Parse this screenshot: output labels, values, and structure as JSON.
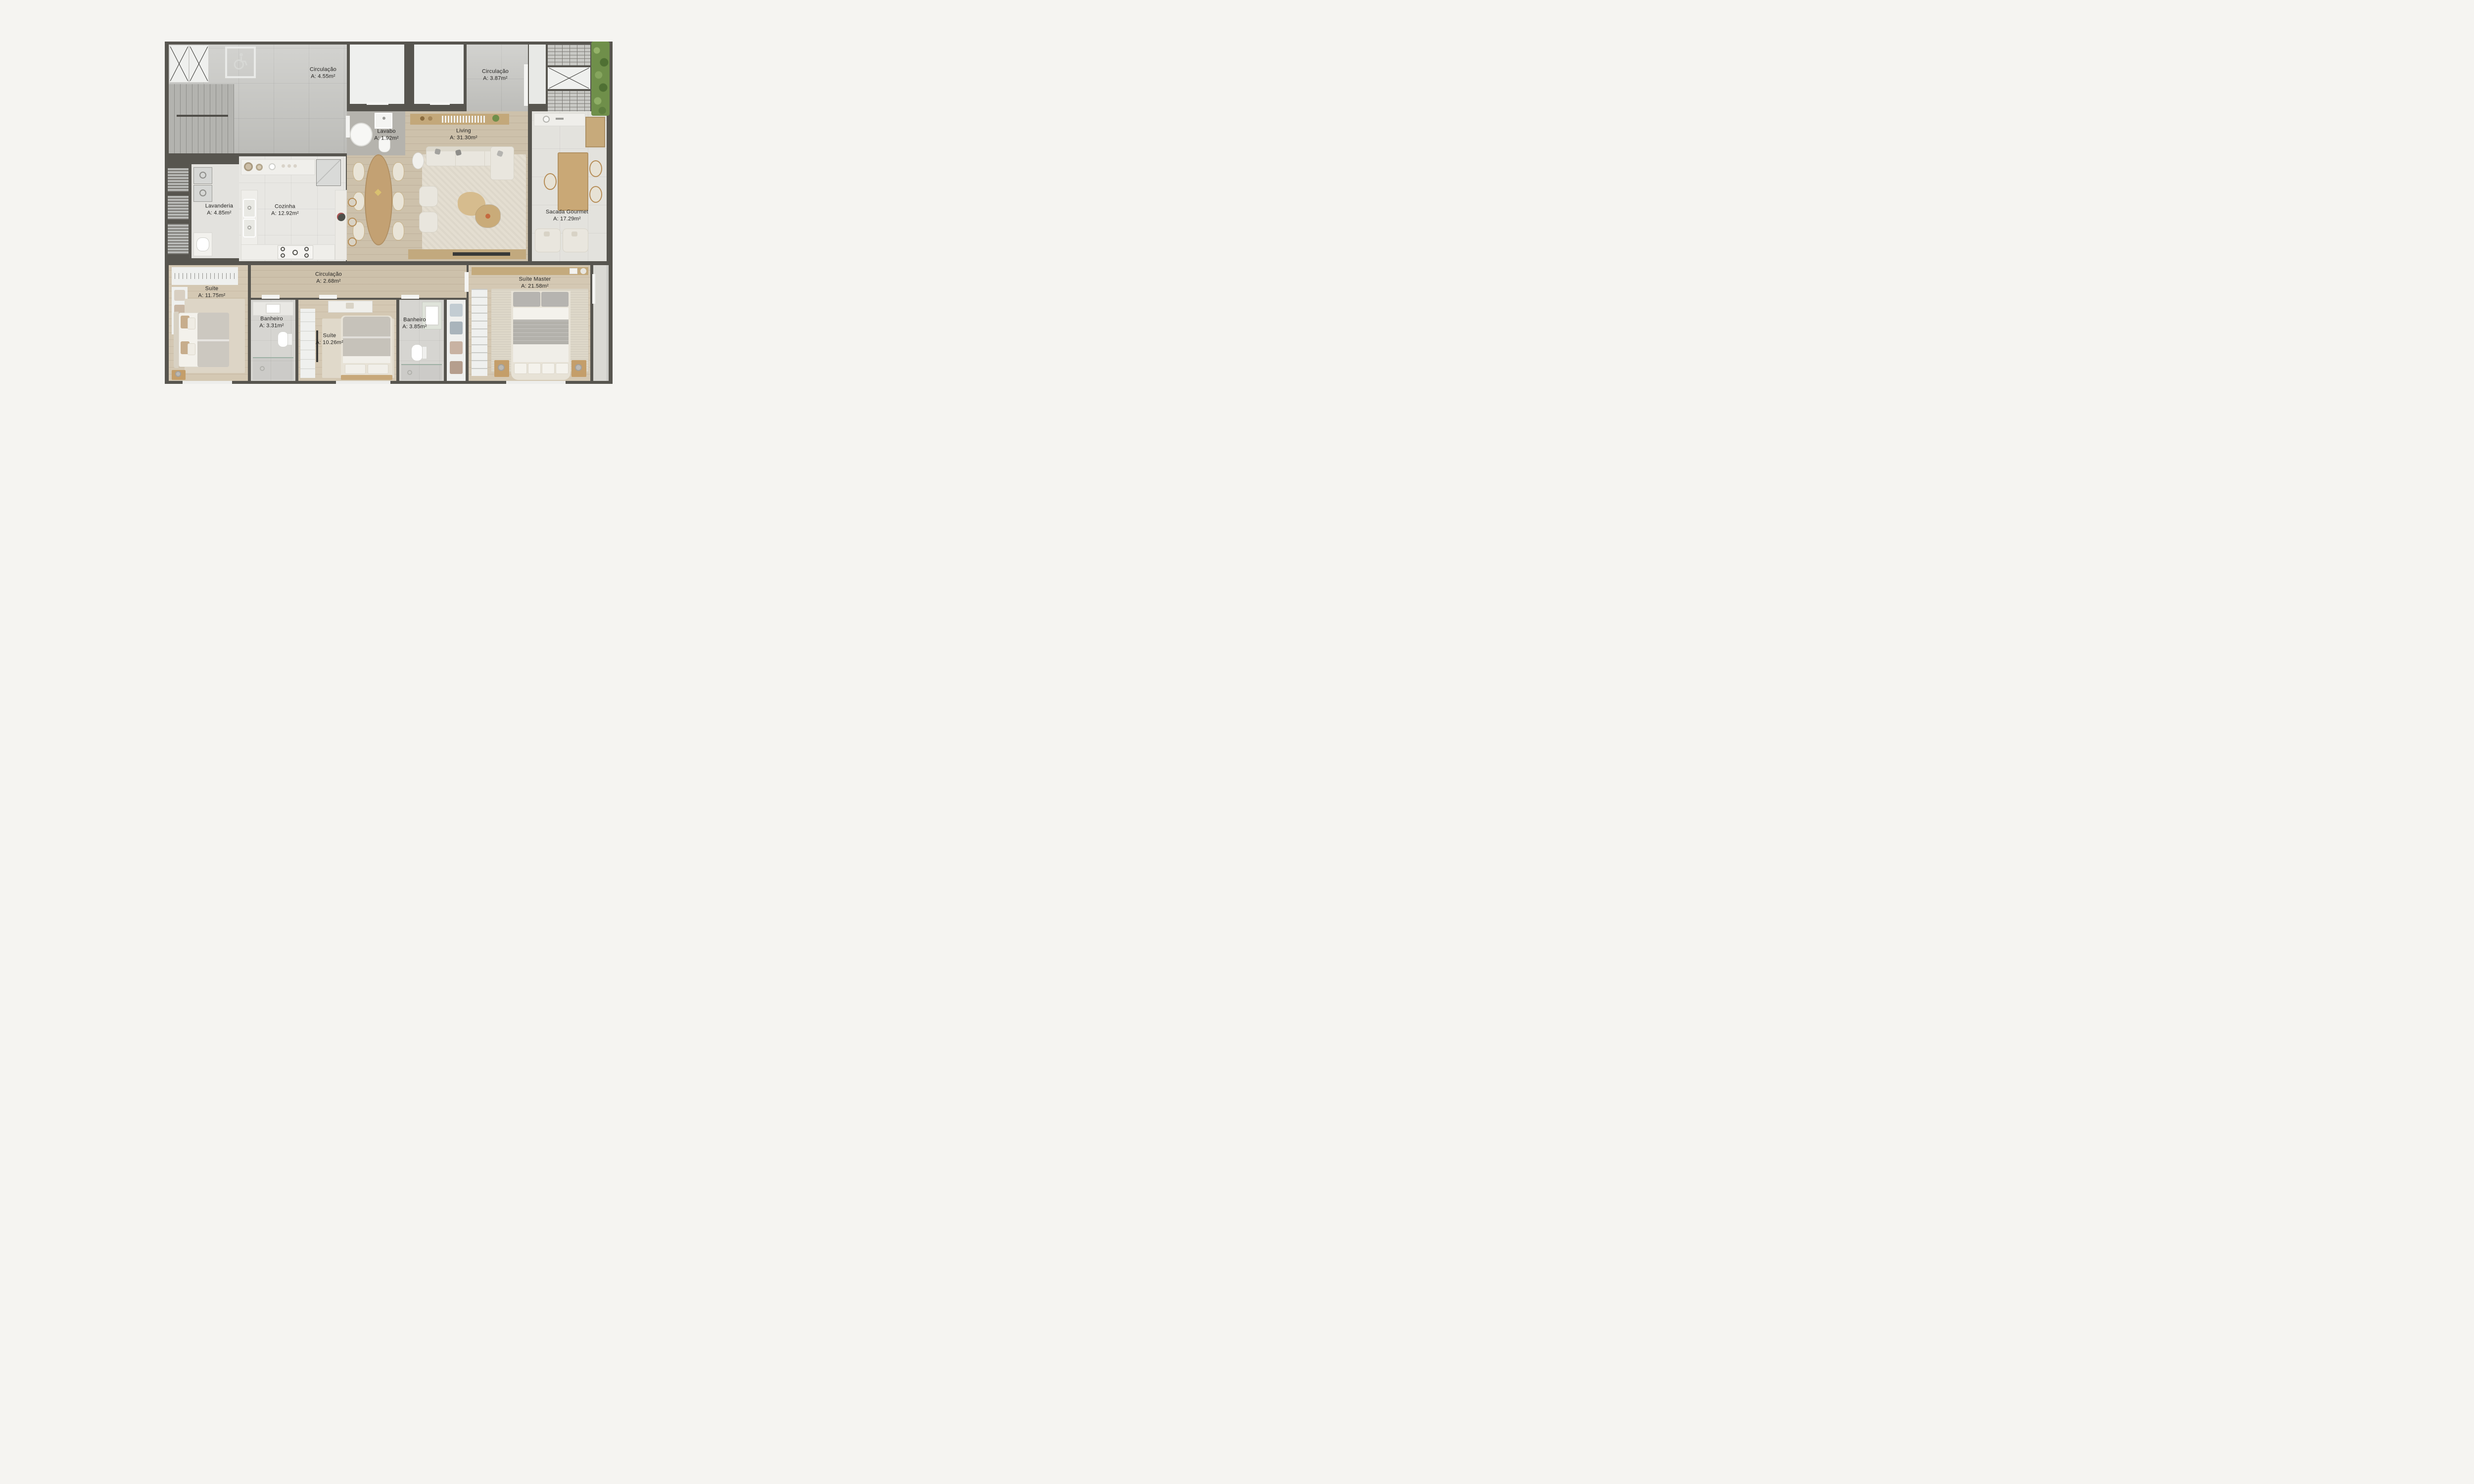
{
  "page": {
    "background": "#f5f4f1",
    "type": "apartment floor plan, top-down render"
  },
  "colors": {
    "walls": "#57554f",
    "concrete_floor": "#c6c6c2",
    "wood_floor": "#cdc1ab",
    "kitchen_tile": "#e8e7e3",
    "balcony_tile": "#e3e2dd",
    "hedge_green": "#6f8f4a",
    "label_text": "#232220",
    "furniture_cream": "#e9e6de",
    "counter_stone": "#efeeea",
    "table_wood": "#c3a173"
  },
  "rooms": [
    {
      "id": "circulacao-1",
      "name": "Circulação",
      "area": "A: 4.55m²"
    },
    {
      "id": "circulacao-2",
      "name": "Circulação",
      "area": "A: 3.87m²"
    },
    {
      "id": "lavabo",
      "name": "Lavabo",
      "area": "A: 1.92m²"
    },
    {
      "id": "living",
      "name": "Living",
      "area": "A: 31.30m²"
    },
    {
      "id": "lavanderia",
      "name": "Lavanderia",
      "area": "A: 4.85m²"
    },
    {
      "id": "cozinha",
      "name": "Cozinha",
      "area": "A: 12.92m²"
    },
    {
      "id": "sacada-gourmet",
      "name": "Sacada Gourmet",
      "area": "A: 17.29m²"
    },
    {
      "id": "circulacao-3",
      "name": "Circulação",
      "area": "A: 2.68m²"
    },
    {
      "id": "suite-1",
      "name": "Suíte",
      "area": "A: 11.75m²"
    },
    {
      "id": "banheiro-1",
      "name": "Banheiro",
      "area": "A: 3.31m²"
    },
    {
      "id": "suite-2",
      "name": "Suíte",
      "area": "A: 10.26m²"
    },
    {
      "id": "banheiro-2",
      "name": "Banheiro",
      "area": "A: 3.85m²"
    },
    {
      "id": "suite-master",
      "name": "Suíte Master",
      "area": "A: 21.58m²"
    }
  ],
  "icons": {
    "accessibility": "wheelchair symbol painted on hall floor",
    "elevator_shaft": "box crossed with X",
    "ventilation_shaft": "brick hatched box",
    "stairs": "treaded stairwell"
  }
}
